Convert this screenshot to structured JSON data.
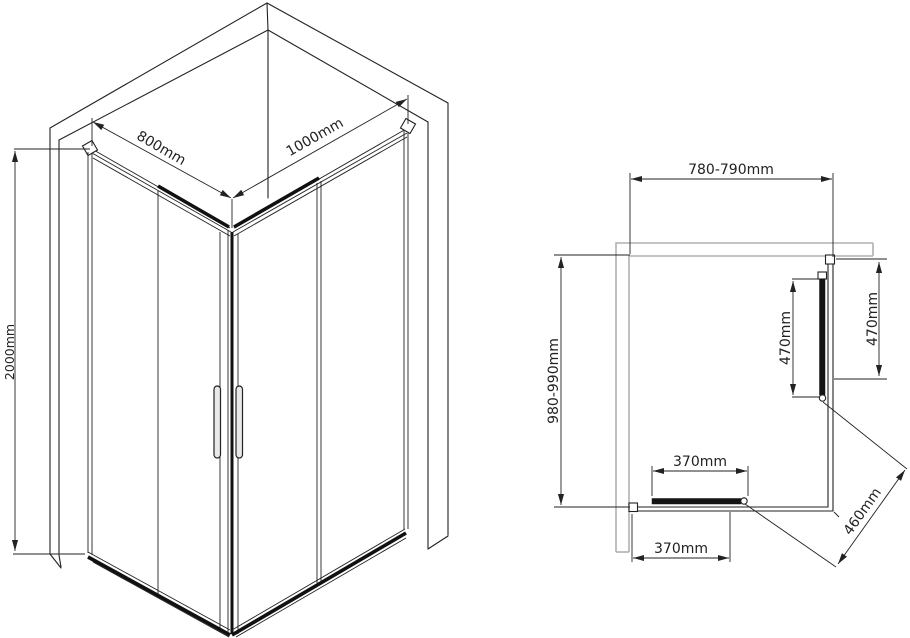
{
  "isometric_view": {
    "width_label": "800mm",
    "depth_label": "1000mm",
    "height_label": "2000mm"
  },
  "plan_view": {
    "width_range_label": "780-790mm",
    "depth_range_label": "980-990mm",
    "side_door_label": "470mm",
    "side_fixed_label": "470mm",
    "front_door_label": "370mm",
    "front_opening_label": "370mm",
    "diagonal_entry_label": "460mm"
  },
  "colors": {
    "line": "#222222",
    "wall_gray": "#b0b0b0",
    "background": "#ffffff"
  }
}
